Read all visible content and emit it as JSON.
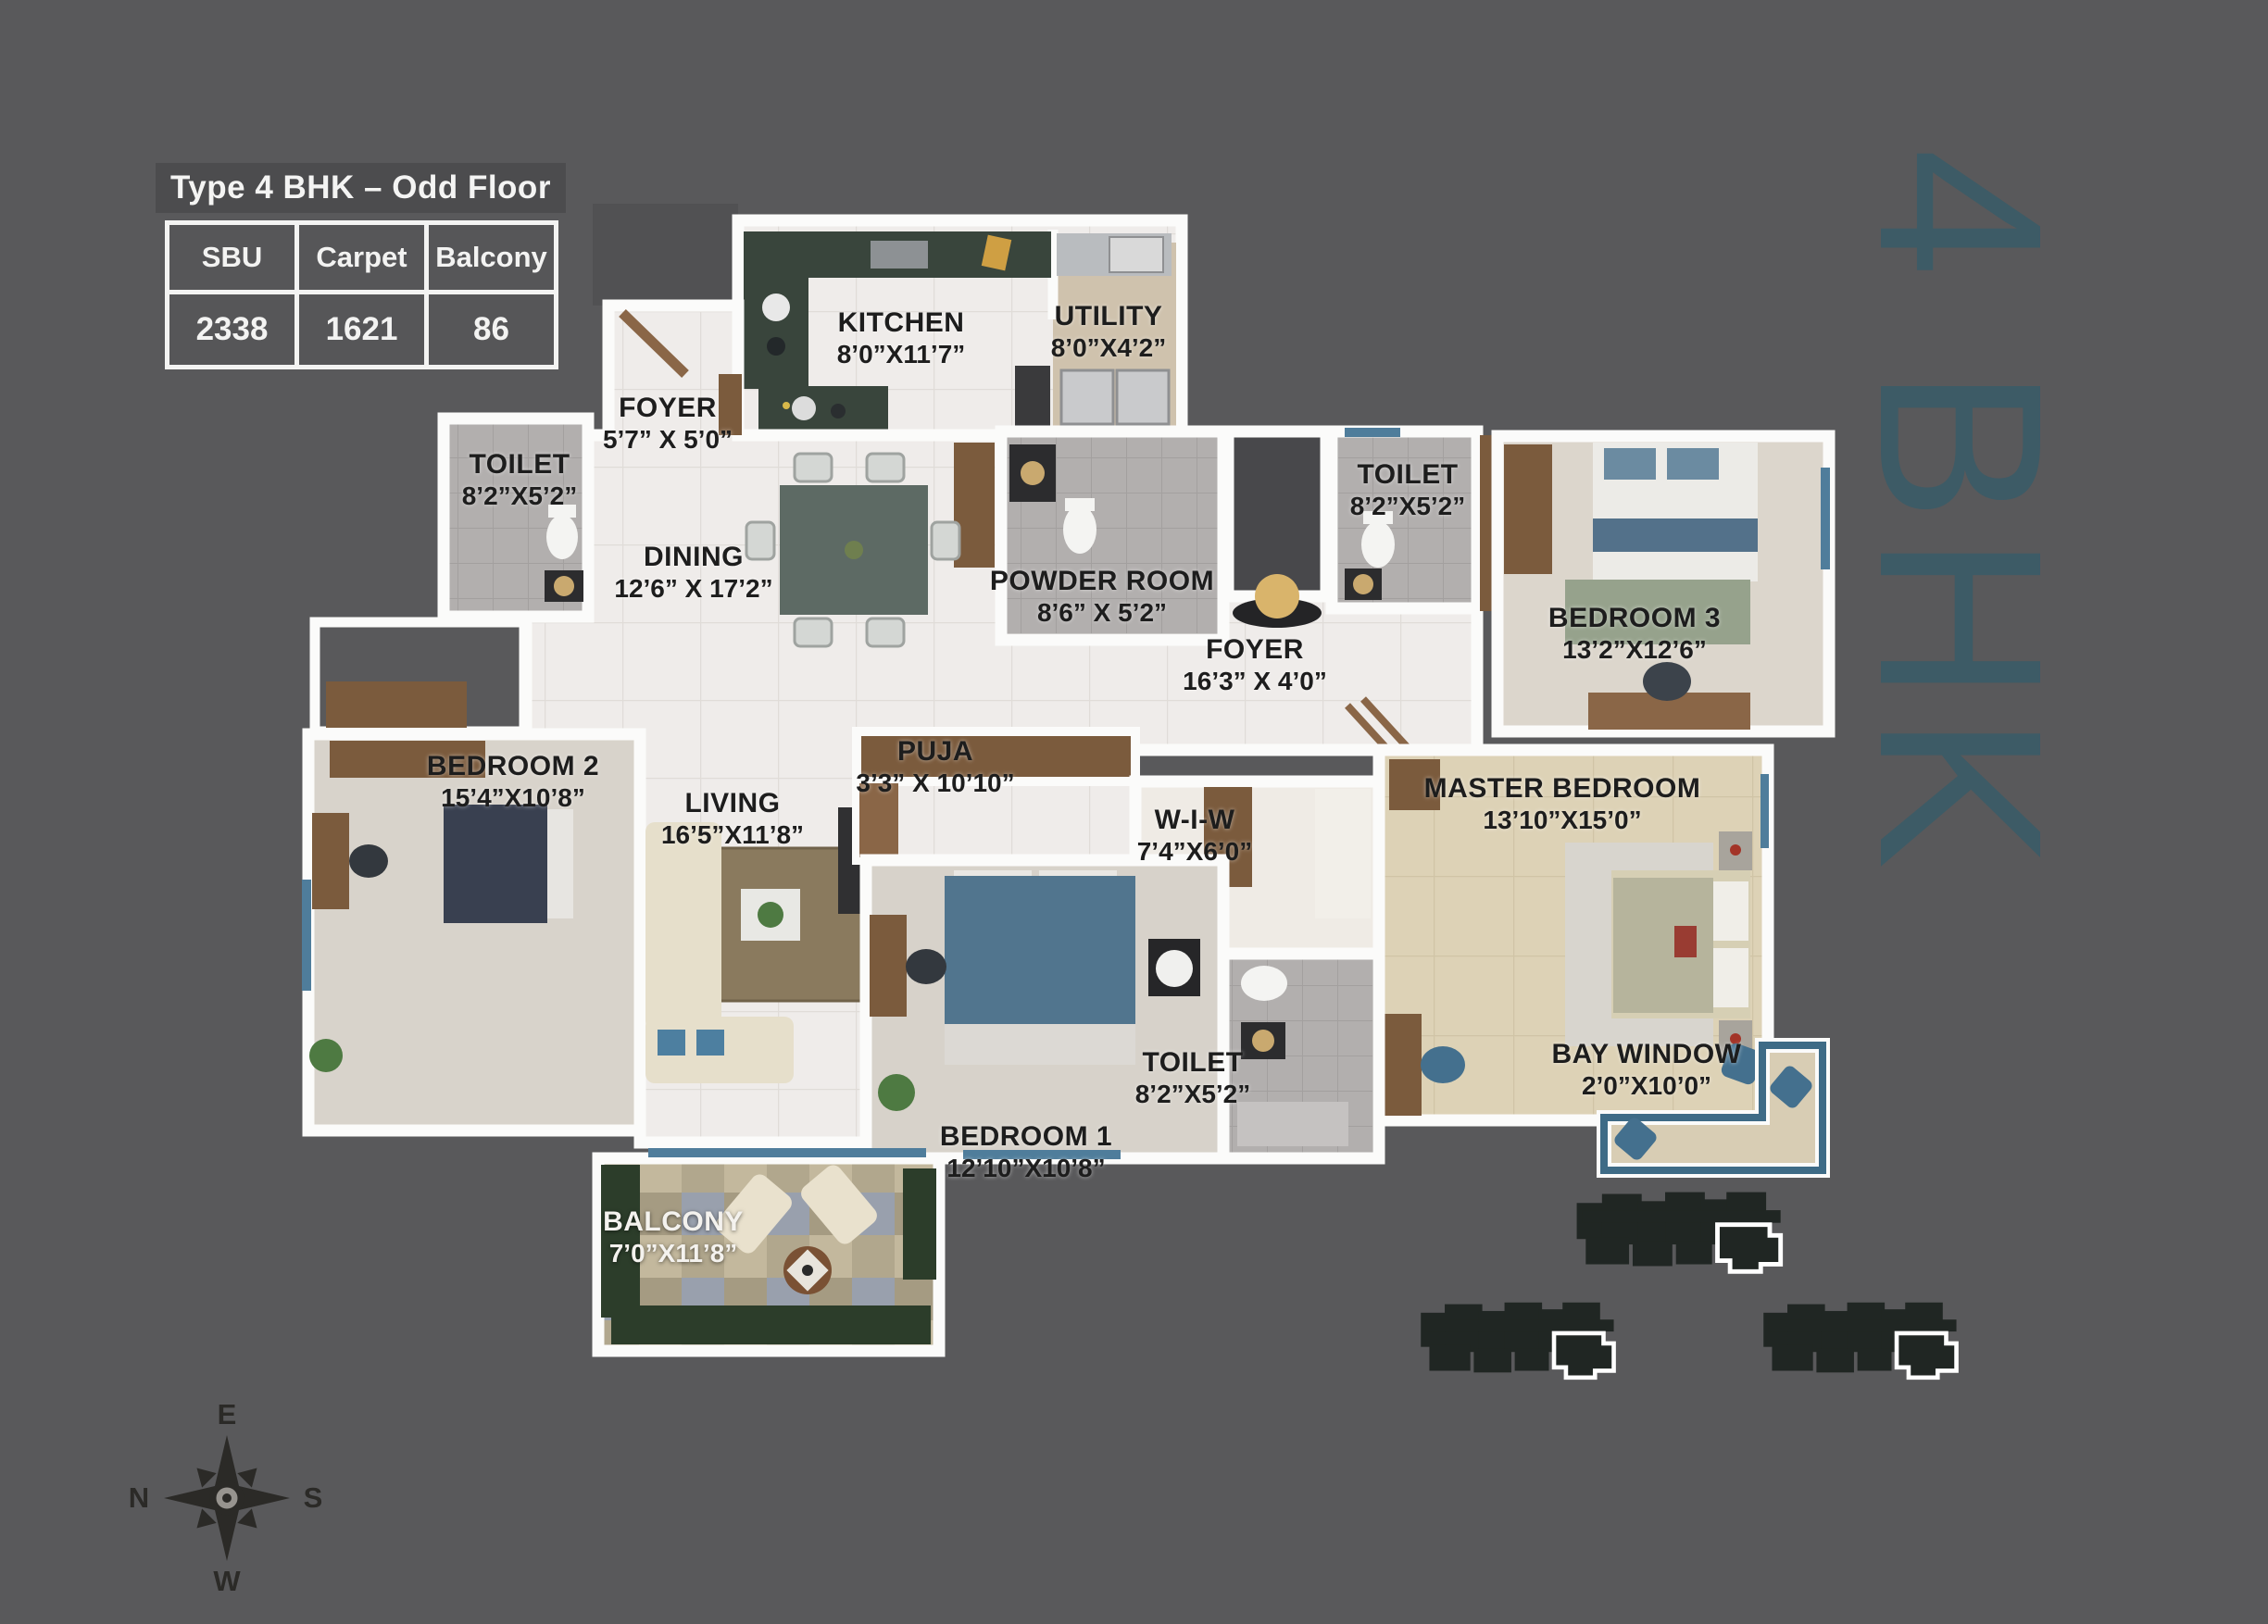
{
  "title": "Type 4 BHK – Odd Floor",
  "area_table": {
    "headers": [
      "SBU",
      "Carpet",
      "Balcony"
    ],
    "values": [
      "2338",
      "1621",
      "86"
    ]
  },
  "watermark": "4 BHK",
  "compass": {
    "east": "E",
    "north": "N",
    "south": "S",
    "west": "W"
  },
  "rooms": [
    {
      "id": "kitchen",
      "name": "KITCHEN",
      "dims": "8’0”X11’7”"
    },
    {
      "id": "utility",
      "name": "UTILITY",
      "dims": "8’0”X4’2”"
    },
    {
      "id": "foyer-entry",
      "name": "FOYER",
      "dims": "5’7” X 5’0”"
    },
    {
      "id": "toilet-left",
      "name": "TOILET",
      "dims": "8’2”X5’2”"
    },
    {
      "id": "dining",
      "name": "DINING",
      "dims": "12’6” X 17’2”"
    },
    {
      "id": "powder-room",
      "name": "POWDER ROOM",
      "dims": "8’6” X 5’2”"
    },
    {
      "id": "toilet-right",
      "name": "TOILET",
      "dims": "8’2”X5’2”"
    },
    {
      "id": "bedroom-3",
      "name": "BEDROOM 3",
      "dims": "13’2”X12’6”"
    },
    {
      "id": "foyer-inner",
      "name": "FOYER",
      "dims": "16’3” X 4’0”"
    },
    {
      "id": "bedroom-2",
      "name": "BEDROOM 2",
      "dims": "15’4”X10’8”"
    },
    {
      "id": "living",
      "name": "LIVING",
      "dims": "16’5”X11’8”"
    },
    {
      "id": "puja",
      "name": "PUJA",
      "dims": "3’3” X 10’10”"
    },
    {
      "id": "wiw",
      "name": "W-I-W",
      "dims": "7’4”X6’0”"
    },
    {
      "id": "master-bedroom",
      "name": "MASTER BEDROOM",
      "dims": "13’10”X15’0”"
    },
    {
      "id": "bedroom-1",
      "name": "BEDROOM 1",
      "dims": "12’10”X10’8”"
    },
    {
      "id": "toilet-bottom",
      "name": "TOILET",
      "dims": "8’2”X5’2”"
    },
    {
      "id": "bay-window",
      "name": "BAY WINDOW",
      "dims": "2’0”X10’0”"
    },
    {
      "id": "balcony",
      "name": "BALCONY",
      "dims": "7’0”X11’8”"
    }
  ],
  "colors": {
    "background": "#59595b",
    "watermark_teal": "#3d5b66",
    "wall_white": "#fbfbfa",
    "label_dark": "#1d1d1d",
    "window_blue": "#4f7d9b"
  }
}
